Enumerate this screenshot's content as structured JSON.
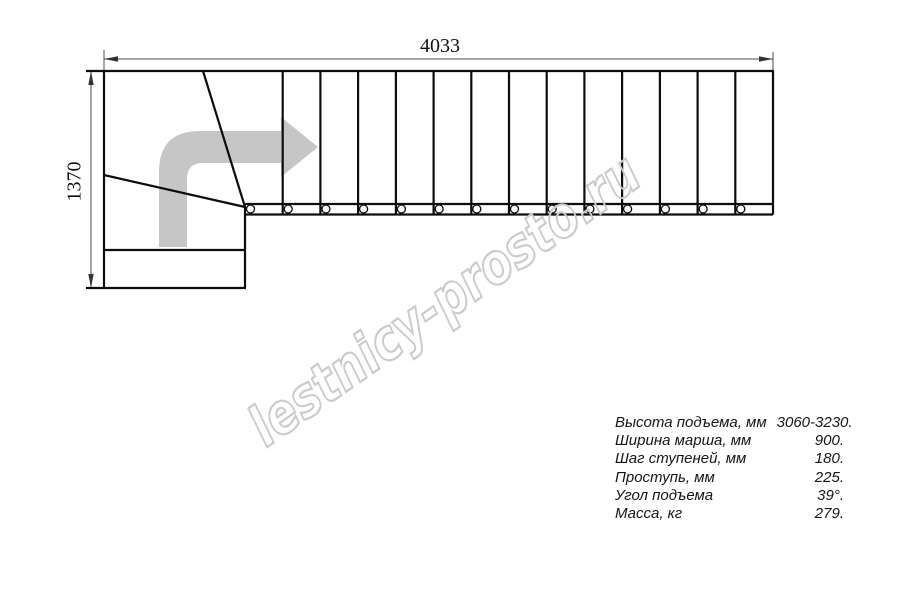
{
  "drawing": {
    "title": "stair-plan-top-view",
    "dim_width_label": "4033",
    "dim_height_label": "1370",
    "straight_step_lines": 13,
    "baluster_circles": 14,
    "colors": {
      "line": "#0d0d0d",
      "dim_line": "#4d4d4d",
      "arrow_gray": "#c6c6c6",
      "watermark_gray": "#cbcbcb"
    }
  },
  "watermark": {
    "text": "lestnicy-prosto.ru"
  },
  "specs": {
    "rows": [
      {
        "label": "Высота подъема, мм",
        "value": "3060-3230."
      },
      {
        "label": "Ширина марша, мм",
        "value": "900."
      },
      {
        "label": "Шаг ступеней, мм",
        "value": "180."
      },
      {
        "label": "Проступь, мм",
        "value": "225."
      },
      {
        "label": "Угол подъема",
        "value": "39°."
      },
      {
        "label": "Масса, кг",
        "value": "279."
      }
    ]
  }
}
